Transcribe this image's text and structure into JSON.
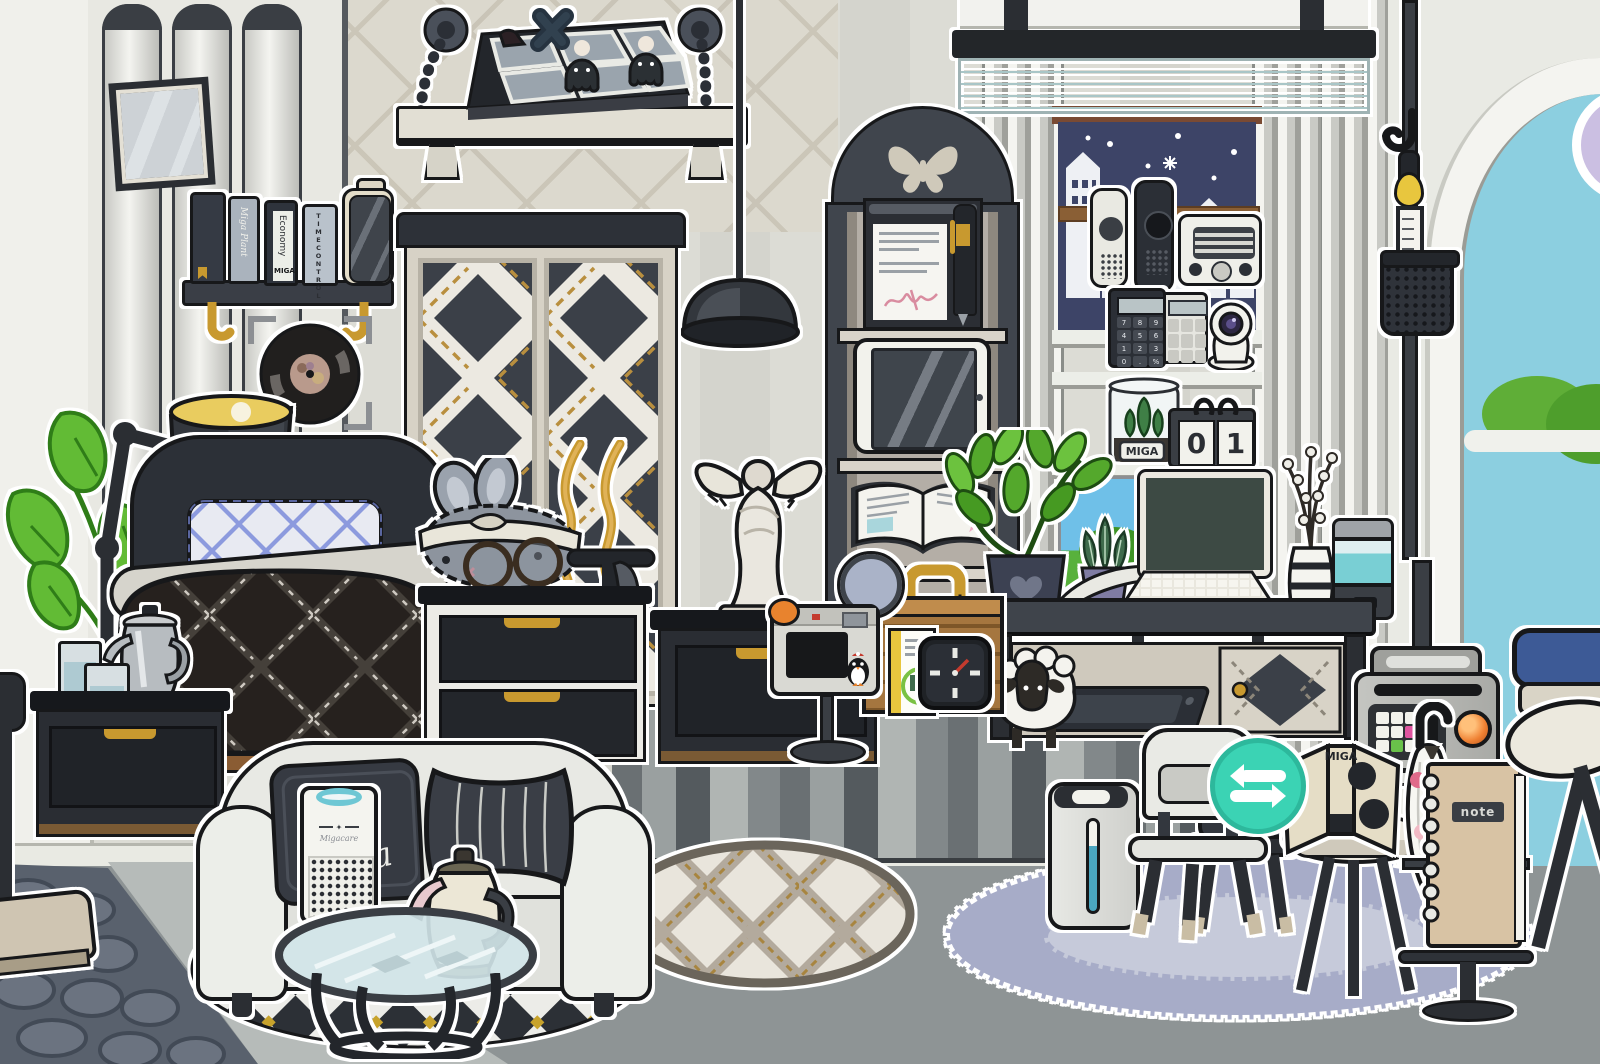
{
  "scene": {
    "description": "Black and white decorated bedroom scene, Miga World style"
  },
  "colors": {
    "wall": "#d8d8d1",
    "floor": "#8e9495",
    "gold_accent": "#c8992f",
    "teal_button": "#3bd3b4",
    "night_window": "#3d4467",
    "sky": "#8ccfe0",
    "lavender_rug": "#a7acc8",
    "lamp_glow": "#e9cc5f",
    "orange_lamp": "#ef8133"
  },
  "wall_shelf": {
    "book_script_spine": "Miga Plant",
    "book_economy_title": "Economy",
    "book_economy_brand": "MIGA",
    "book_time_title": "TIMECONTROL"
  },
  "window_shelf": {
    "terrarium_label": "MIGA",
    "calendar_left_digit": "0",
    "calendar_right_digit": "1",
    "calculator_keys": [
      "7",
      "8",
      "9",
      "4",
      "5",
      "6",
      "1",
      "2",
      "3",
      "0",
      ".",
      "%"
    ]
  },
  "sofa": {
    "pillow_script": "miga"
  },
  "air_purifier": {
    "brand": "Migacare"
  },
  "side_table_book": {
    "spine": "MIGA"
  },
  "notebook": {
    "label": "note"
  },
  "icons": {
    "swap": "⇄"
  }
}
